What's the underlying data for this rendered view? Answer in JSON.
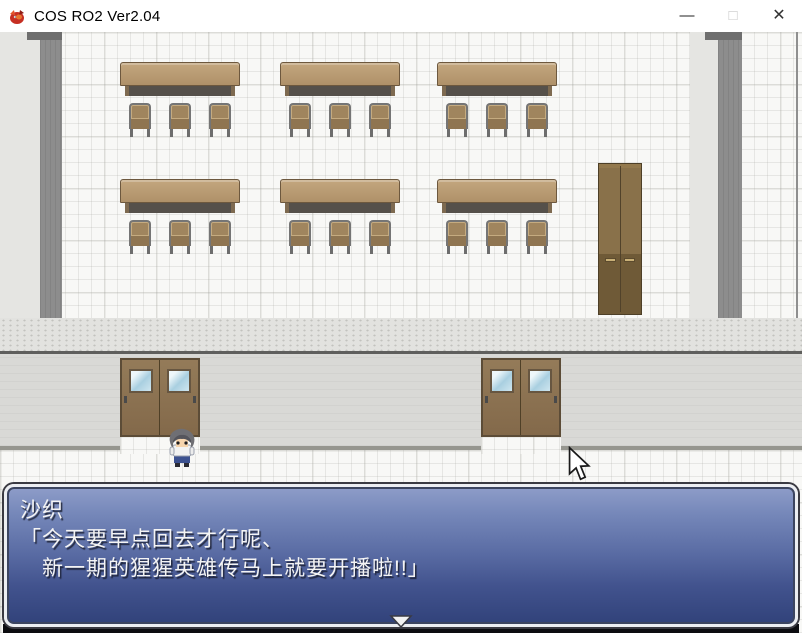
{
  "window": {
    "title": "COS RO2 Ver2.04",
    "controls": {
      "minimize": "—",
      "maximize": "□",
      "close": "✕"
    }
  },
  "dialog": {
    "speaker": "沙织",
    "lines": [
      "「今天要早点回去才行呢、",
      "　新一期的猩猩英雄传马上就要开播啦!!」"
    ]
  },
  "icons": {
    "app_icon": "red-creature-game-icon",
    "continue_indicator": "down-triangle",
    "cursor": "arrow-pointer"
  },
  "colors": {
    "titlebar_bg": "#ffffff",
    "dialog_top": "#8e9dc9",
    "dialog_bottom": "#31427a",
    "dialog_border": "#eceef2",
    "door_brown": "#8b7252",
    "desk_brown": "#b59872",
    "wall_grey": "#8d8d8d",
    "hall_wall_grey": "#d9d9d6",
    "floor_white": "#f8f8f6"
  },
  "scene": {
    "desk_rows_y": [
      30,
      147
    ],
    "desk_cols_x": [
      120,
      280,
      437
    ],
    "chair_offsets_x": [
      9,
      49,
      89
    ],
    "doors_x": [
      120,
      481
    ]
  }
}
